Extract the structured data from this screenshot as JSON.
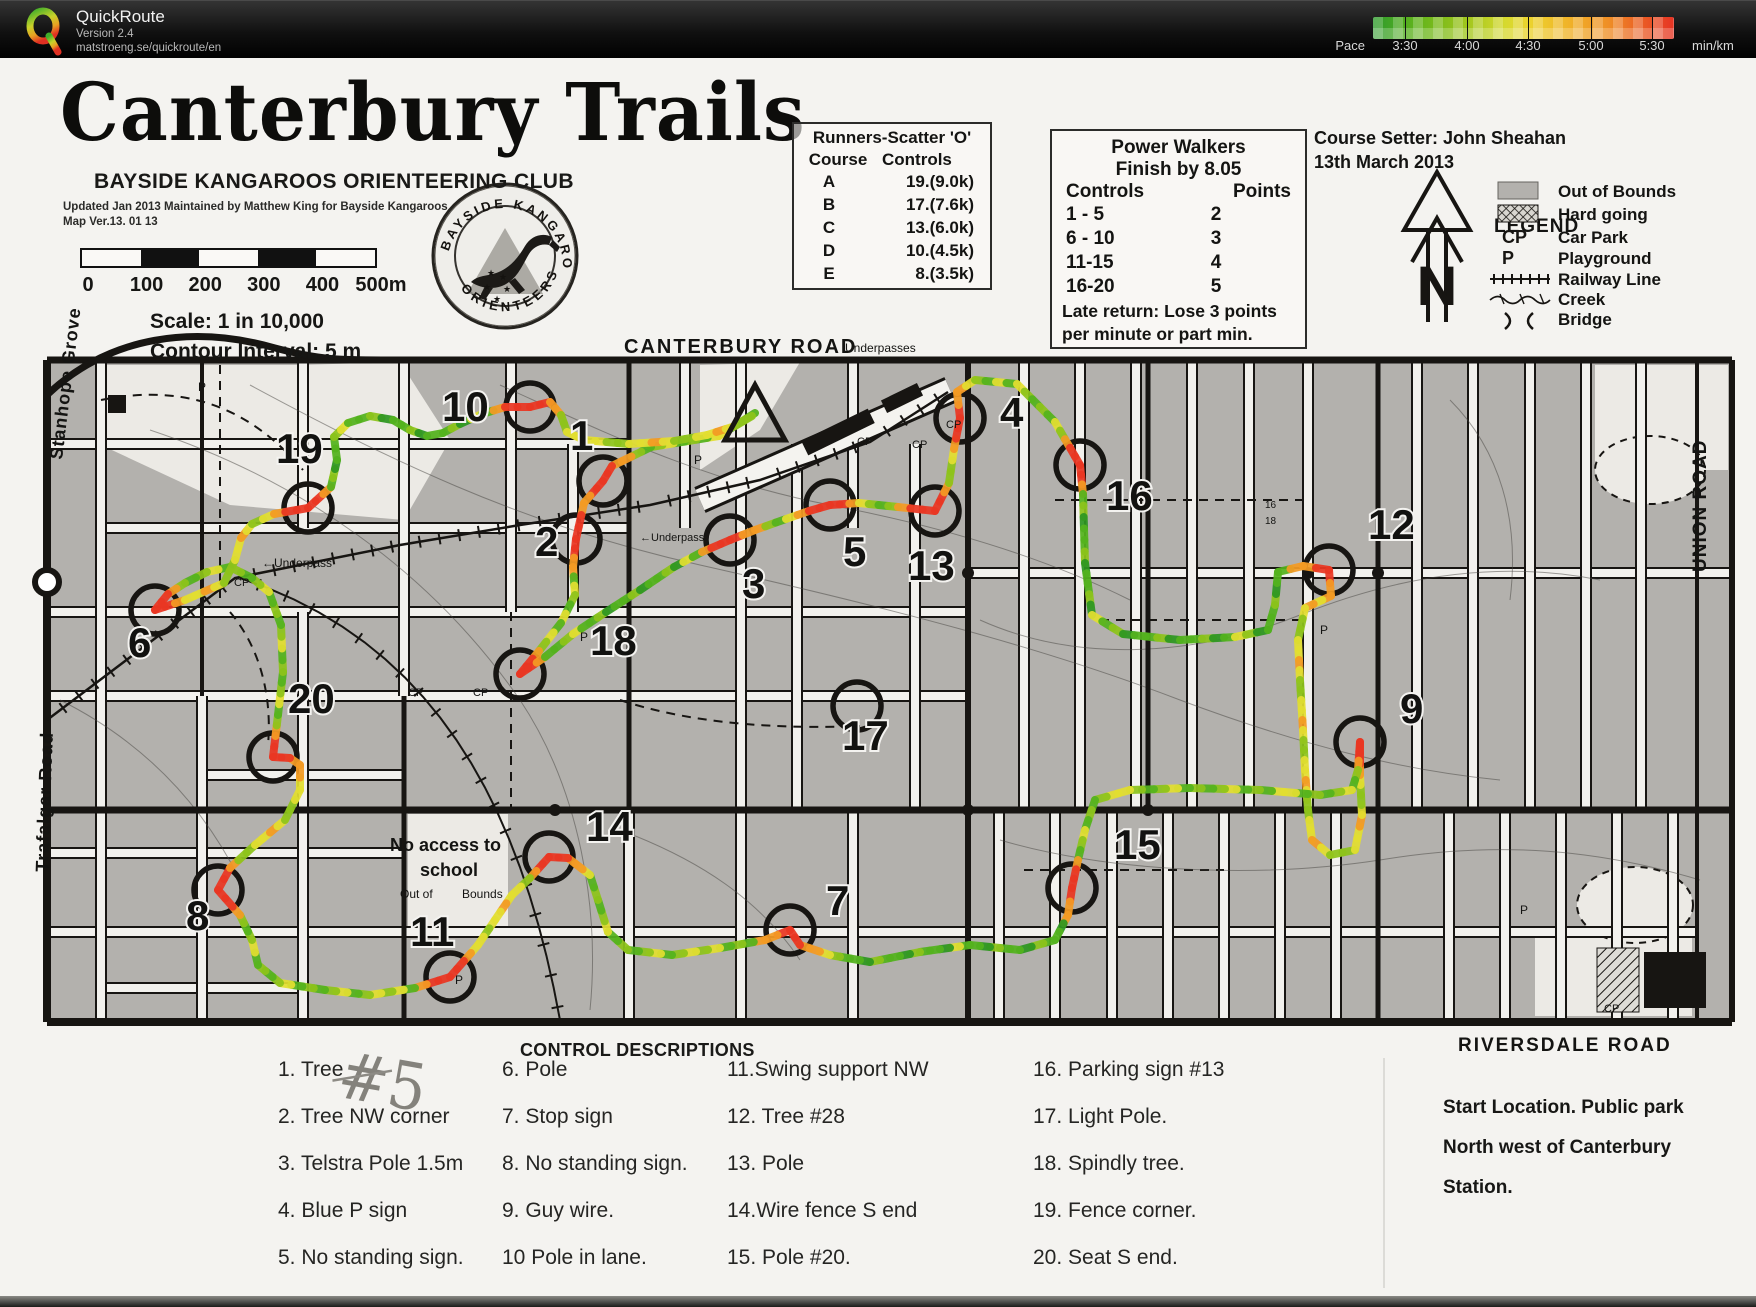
{
  "header": {
    "app_name": "QuickRoute",
    "version": "Version 2.4",
    "url": "matstroeng.se/quickroute/en",
    "pace_label": "Pace",
    "unit_label": "min/km",
    "ticks": [
      "3:30",
      "4:00",
      "4:30",
      "5:00",
      "5:30"
    ],
    "gradient_colors": [
      "#2d9a2d",
      "#9cc41c",
      "#ecd32e",
      "#ef8f26",
      "#e63424"
    ]
  },
  "title_block": {
    "title": "Canterbury Trails",
    "club": "BAYSIDE KANGAROOS ORIENTEERING CLUB",
    "updated": "Updated Jan 2013 Maintained by Matthew King for Bayside Kangaroos",
    "map_version": "Map Ver.13. 01 13",
    "scale_labels": [
      "0",
      "100",
      "200",
      "300",
      "400",
      "500m"
    ],
    "scale_text": "Scale:  1 in 10,000",
    "contour_text": "Contour Interval:  5 m",
    "badge_top": "BAYSIDE  KANGAROOS",
    "badge_bottom": "ORIENTEERS"
  },
  "runners_box": {
    "title": "Runners-Scatter 'O'",
    "col1": "Course",
    "col2": "Controls",
    "rows": [
      [
        "A",
        "19.(9.0k)"
      ],
      [
        "B",
        "17.(7.6k)"
      ],
      [
        "C",
        "13.(6.0k)"
      ],
      [
        "D",
        "10.(4.5k)"
      ],
      [
        "E",
        "8.(3.5k)"
      ]
    ]
  },
  "walkers_box": {
    "title": "Power Walkers",
    "subtitle": "Finish by 8.05",
    "col1": "Controls",
    "col2": "Points",
    "rows": [
      [
        "1 - 5",
        "2"
      ],
      [
        "6 - 10",
        "3"
      ],
      [
        "11-15",
        "4"
      ],
      [
        "16-20",
        "5"
      ]
    ],
    "note1": "Late return: Lose 3 points",
    "note2": "per minute or part min."
  },
  "course_setter": {
    "line1": "Course Setter: John Sheahan",
    "line2": "13th March 2013"
  },
  "legend": {
    "title": "LEGEND",
    "north_letter": "N",
    "items": [
      {
        "symbol": "out-of-bounds",
        "symbol_text": "",
        "label": "Out of Bounds"
      },
      {
        "symbol": "hard-going",
        "symbol_text": "",
        "label": "Hard going"
      },
      {
        "symbol": "text",
        "symbol_text": "CP",
        "label": "Car Park"
      },
      {
        "symbol": "text",
        "symbol_text": "P",
        "label": "Playground"
      },
      {
        "symbol": "railway",
        "symbol_text": "",
        "label": "Railway Line"
      },
      {
        "symbol": "creek",
        "symbol_text": "",
        "label": "Creek"
      },
      {
        "symbol": "bridge",
        "symbol_text": "",
        "label": "Bridge"
      }
    ]
  },
  "map": {
    "road_labels": [
      {
        "t": "CANTERBURY  ROAD",
        "x": 624,
        "y": 353,
        "s": 20,
        "w": "bold",
        "r": 0,
        "ls": 2
      },
      {
        "t": "Underpasses",
        "x": 845,
        "y": 352,
        "s": 12,
        "w": "normal",
        "r": 0,
        "ls": 0
      },
      {
        "t": "←Underpass",
        "x": 262,
        "y": 567,
        "s": 12,
        "w": "normal",
        "r": 0,
        "ls": 0
      },
      {
        "t": "←Underpass",
        "x": 640,
        "y": 541,
        "s": 11,
        "w": "normal",
        "r": 0,
        "ls": 0
      },
      {
        "t": "Stanhope Grove",
        "x": 62,
        "y": 460,
        "s": 18,
        "w": "bold",
        "r": -83,
        "ls": 1
      },
      {
        "t": "Trafalgar Road",
        "x": 48,
        "y": 872,
        "s": 18,
        "w": "bold",
        "r": -88,
        "ls": 1
      },
      {
        "t": "UNION ROAD",
        "x": 1706,
        "y": 572,
        "s": 19,
        "w": "bold",
        "r": -90,
        "ls": 1
      },
      {
        "t": "RIVERSDALE   ROAD",
        "x": 1458,
        "y": 1051,
        "s": 19,
        "w": "bold",
        "r": 0,
        "ls": 2
      },
      {
        "t": "No access to",
        "x": 390,
        "y": 851,
        "s": 18,
        "w": "bold",
        "r": 0,
        "ls": 0
      },
      {
        "t": "school",
        "x": 420,
        "y": 876,
        "s": 18,
        "w": "bold",
        "r": 0,
        "ls": 0
      },
      {
        "t": "Out of",
        "x": 400,
        "y": 898,
        "s": 12,
        "w": "normal",
        "r": 0,
        "ls": 0
      },
      {
        "t": "Bounds",
        "x": 462,
        "y": 898,
        "s": 12,
        "w": "normal",
        "r": 0,
        "ls": 0
      },
      {
        "t": "CP",
        "x": 234,
        "y": 586,
        "s": 11,
        "w": "normal",
        "r": 0,
        "ls": 0
      },
      {
        "t": "CP",
        "x": 408,
        "y": 696,
        "s": 11,
        "w": "normal",
        "r": 0,
        "ls": 0
      },
      {
        "t": "CP",
        "x": 473,
        "y": 696,
        "s": 11,
        "w": "normal",
        "r": 0,
        "ls": 0
      },
      {
        "t": "CP",
        "x": 857,
        "y": 445,
        "s": 11,
        "w": "normal",
        "r": 0,
        "ls": 0
      },
      {
        "t": "CP",
        "x": 912,
        "y": 448,
        "s": 11,
        "w": "normal",
        "r": 0,
        "ls": 0
      },
      {
        "t": "CP",
        "x": 946,
        "y": 428,
        "s": 11,
        "w": "normal",
        "r": 0,
        "ls": 0
      },
      {
        "t": "CP",
        "x": 1604,
        "y": 1012,
        "s": 11,
        "w": "normal",
        "r": 0,
        "ls": 0
      },
      {
        "t": "P",
        "x": 198,
        "y": 391,
        "s": 12,
        "w": "normal",
        "r": 0,
        "ls": 0
      },
      {
        "t": "P",
        "x": 694,
        "y": 464,
        "s": 12,
        "w": "normal",
        "r": 0,
        "ls": 0
      },
      {
        "t": "P",
        "x": 455,
        "y": 984,
        "s": 12,
        "w": "normal",
        "r": 0,
        "ls": 0
      },
      {
        "t": "P",
        "x": 580,
        "y": 641,
        "s": 12,
        "w": "normal",
        "r": 0,
        "ls": 0
      },
      {
        "t": "P",
        "x": 1320,
        "y": 634,
        "s": 12,
        "w": "normal",
        "r": 0,
        "ls": 0
      },
      {
        "t": "P",
        "x": 1520,
        "y": 914,
        "s": 12,
        "w": "normal",
        "r": 0,
        "ls": 0
      },
      {
        "t": "16",
        "x": 1265,
        "y": 508,
        "s": 10,
        "w": "normal",
        "r": 0,
        "ls": 0
      },
      {
        "t": "18",
        "x": 1265,
        "y": 524,
        "s": 10,
        "w": "normal",
        "r": 0,
        "ls": 0
      }
    ],
    "controls": [
      {
        "n": "1",
        "cx": 603,
        "cy": 481,
        "lx": 570,
        "ly": 450
      },
      {
        "n": "2",
        "cx": 576,
        "cy": 539,
        "lx": 535,
        "ly": 556
      },
      {
        "n": "3",
        "cx": 730,
        "cy": 540,
        "lx": 742,
        "ly": 598
      },
      {
        "n": "4",
        "cx": 960,
        "cy": 418,
        "lx": 1000,
        "ly": 427
      },
      {
        "n": "5",
        "cx": 830,
        "cy": 505,
        "lx": 843,
        "ly": 566
      },
      {
        "n": "6",
        "cx": 155,
        "cy": 610,
        "lx": 128,
        "ly": 657
      },
      {
        "n": "7",
        "cx": 790,
        "cy": 930,
        "lx": 826,
        "ly": 915
      },
      {
        "n": "8",
        "cx": 218,
        "cy": 890,
        "lx": 186,
        "ly": 930
      },
      {
        "n": "9",
        "cx": 1360,
        "cy": 742,
        "lx": 1400,
        "ly": 723
      },
      {
        "n": "10",
        "cx": 530,
        "cy": 407,
        "lx": 442,
        "ly": 421
      },
      {
        "n": "11",
        "cx": 450,
        "cy": 977,
        "lx": 410,
        "ly": 946
      },
      {
        "n": "12",
        "cx": 1329,
        "cy": 570,
        "lx": 1368,
        "ly": 539
      },
      {
        "n": "13",
        "cx": 935,
        "cy": 511,
        "lx": 908,
        "ly": 580
      },
      {
        "n": "14",
        "cx": 549,
        "cy": 857,
        "lx": 586,
        "ly": 841
      },
      {
        "n": "15",
        "cx": 1072,
        "cy": 888,
        "lx": 1114,
        "ly": 859
      },
      {
        "n": "16",
        "cx": 1080,
        "cy": 465,
        "lx": 1106,
        "ly": 510
      },
      {
        "n": "17",
        "cx": 857,
        "cy": 706,
        "lx": 842,
        "ly": 750
      },
      {
        "n": "18",
        "cx": 520,
        "cy": 674,
        "lx": 590,
        "ly": 655
      },
      {
        "n": "19",
        "cx": 308,
        "cy": 508,
        "lx": 276,
        "ly": 463
      },
      {
        "n": "20",
        "cx": 273,
        "cy": 757,
        "lx": 288,
        "ly": 713
      }
    ]
  },
  "control_descriptions": {
    "title": "CONTROL DESCRIPTIONS",
    "handwritten": "#5",
    "columns": [
      [
        "1. Tree",
        "2. Tree NW corner",
        "3. Telstra Pole 1.5m",
        "4. Blue P sign",
        "5. No standing sign."
      ],
      [
        "6. Pole",
        "7. Stop sign",
        "8. No standing sign.",
        "9. Guy wire.",
        "10 Pole in lane."
      ],
      [
        "11.Swing support NW",
        "12. Tree #28",
        "13. Pole",
        "14.Wire fence S end",
        "15. Pole #20."
      ],
      [
        "16. Parking sign #13",
        "17. Light Pole.",
        "18. Spindly tree.",
        "19. Fence corner.",
        "20. Seat S end."
      ]
    ]
  },
  "start_location": {
    "lines": [
      "Start Location. Public park",
      "North west  of Canterbury",
      "Station."
    ]
  }
}
